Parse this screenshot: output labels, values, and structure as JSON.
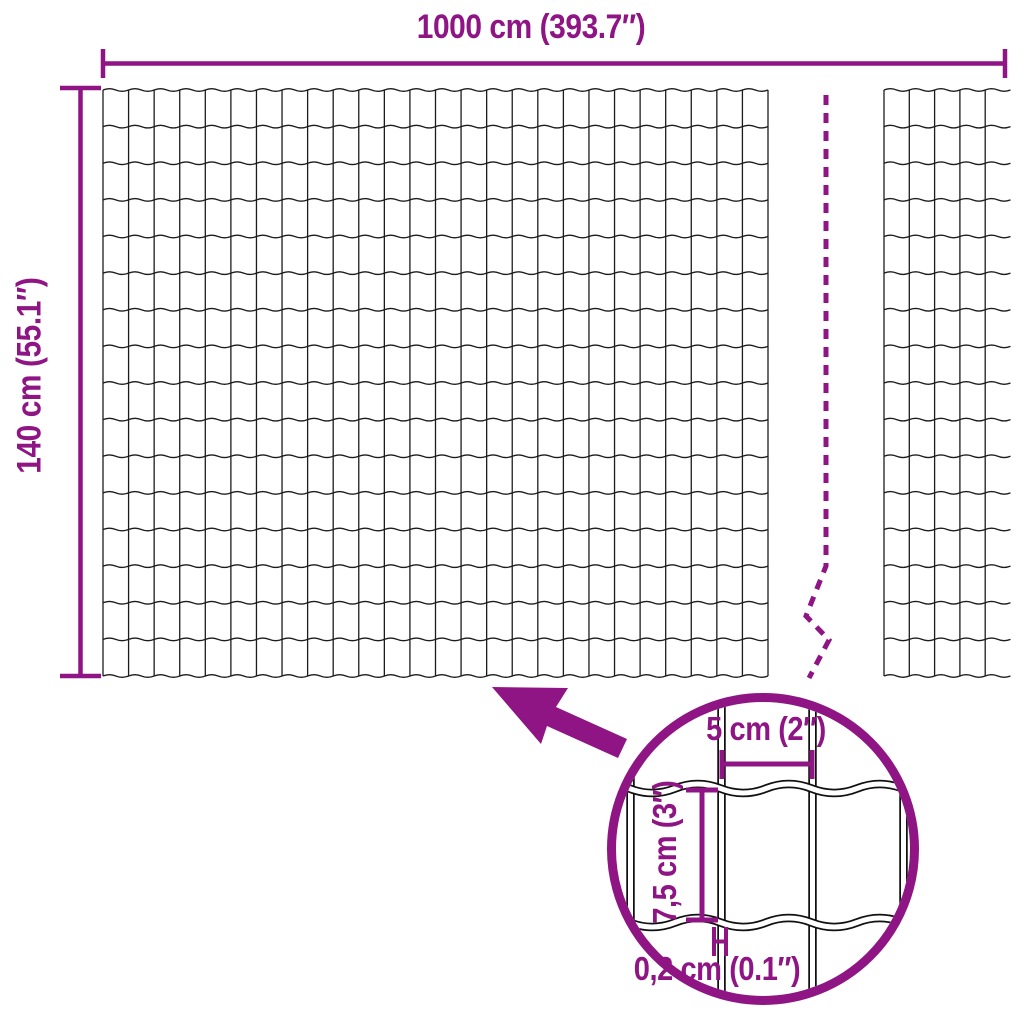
{
  "colors": {
    "accent": "#8F1484",
    "wire": "#1C1C1C"
  },
  "dimensions": {
    "total_width": {
      "label": "1000 cm (393.7″)"
    },
    "total_height": {
      "label": "140 cm (55.1″)"
    },
    "mesh_opening_width": {
      "label": "5 cm (2″)"
    },
    "mesh_opening_height": {
      "label": "7,5 cm (3″)"
    },
    "wire_thickness": {
      "label": "0,2 cm (0.1″)"
    }
  },
  "mesh": {
    "rows": 16,
    "columns": 26,
    "right_section_columns": 5
  }
}
